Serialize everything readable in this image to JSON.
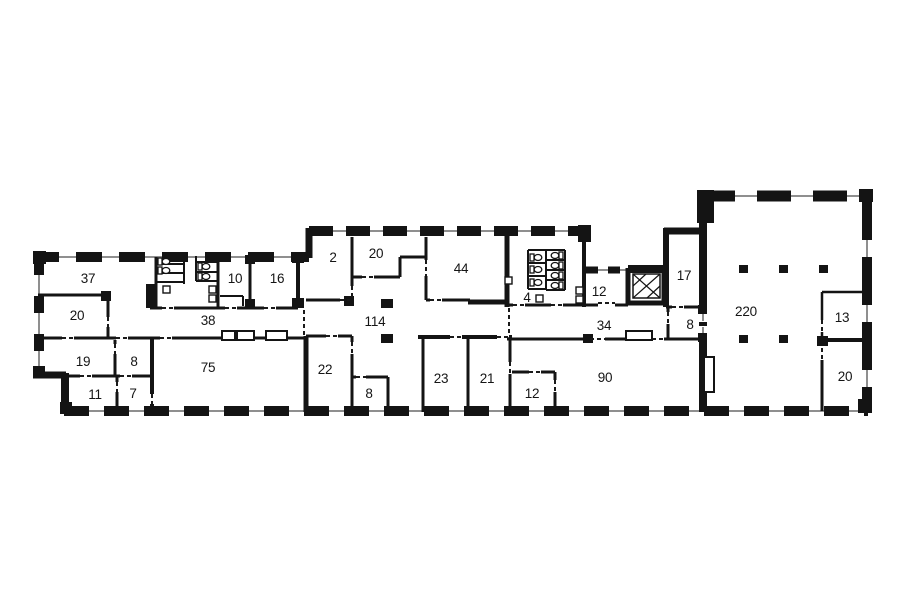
{
  "title": "office floor plan",
  "colors": {
    "background": "#ffffff",
    "wall": "#141414",
    "window_line": "#8f8f8f",
    "label": "#151515"
  },
  "rooms": [
    {
      "label": "37",
      "x": 88,
      "y": 278
    },
    {
      "label": "20",
      "x": 77,
      "y": 315
    },
    {
      "label": "19",
      "x": 83,
      "y": 361
    },
    {
      "label": "8",
      "x": 134,
      "y": 361
    },
    {
      "label": "11",
      "x": 95,
      "y": 394
    },
    {
      "label": "7",
      "x": 133,
      "y": 393
    },
    {
      "label": "38",
      "x": 208,
      "y": 320
    },
    {
      "label": "10",
      "x": 235,
      "y": 278
    },
    {
      "label": "16",
      "x": 277,
      "y": 278
    },
    {
      "label": "75",
      "x": 208,
      "y": 367
    },
    {
      "label": "2",
      "x": 333,
      "y": 257
    },
    {
      "label": "20",
      "x": 376,
      "y": 253
    },
    {
      "label": "44",
      "x": 461,
      "y": 268
    },
    {
      "label": "114",
      "x": 375,
      "y": 321
    },
    {
      "label": "22",
      "x": 325,
      "y": 369
    },
    {
      "label": "8",
      "x": 369,
      "y": 393
    },
    {
      "label": "23",
      "x": 441,
      "y": 378
    },
    {
      "label": "21",
      "x": 487,
      "y": 378
    },
    {
      "label": "12",
      "x": 532,
      "y": 393
    },
    {
      "label": "4",
      "x": 527,
      "y": 297
    },
    {
      "label": "12",
      "x": 599,
      "y": 291
    },
    {
      "label": "34",
      "x": 604,
      "y": 325
    },
    {
      "label": "17",
      "x": 684,
      "y": 275
    },
    {
      "label": "8",
      "x": 690,
      "y": 324
    },
    {
      "label": "90",
      "x": 605,
      "y": 377
    },
    {
      "label": "220",
      "x": 746,
      "y": 311
    },
    {
      "label": "13",
      "x": 842,
      "y": 317
    },
    {
      "label": "20",
      "x": 845,
      "y": 376
    }
  ],
  "fixtures": {
    "toilets": [
      {
        "x": 158,
        "y": 258,
        "dir": "e"
      },
      {
        "x": 158,
        "y": 267,
        "dir": "e"
      },
      {
        "x": 198,
        "y": 263,
        "dir": "e"
      },
      {
        "x": 198,
        "y": 273,
        "dir": "e"
      },
      {
        "x": 530,
        "y": 254,
        "dir": "e"
      },
      {
        "x": 530,
        "y": 266,
        "dir": "e"
      },
      {
        "x": 530,
        "y": 279,
        "dir": "e"
      },
      {
        "x": 563,
        "y": 252,
        "dir": "w"
      },
      {
        "x": 563,
        "y": 262,
        "dir": "w"
      },
      {
        "x": 563,
        "y": 272,
        "dir": "w"
      },
      {
        "x": 563,
        "y": 282,
        "dir": "w"
      }
    ],
    "sinks": [
      {
        "x": 163,
        "y": 286
      },
      {
        "x": 209,
        "y": 286
      },
      {
        "x": 209,
        "y": 295
      },
      {
        "x": 505,
        "y": 277
      },
      {
        "x": 536,
        "y": 295
      },
      {
        "x": 576,
        "y": 287
      },
      {
        "x": 576,
        "y": 296
      }
    ],
    "columns": [
      {
        "x": 381,
        "y": 299,
        "w": 12,
        "h": 9
      },
      {
        "x": 381,
        "y": 334,
        "w": 12,
        "h": 9
      },
      {
        "x": 739,
        "y": 265,
        "w": 9,
        "h": 8
      },
      {
        "x": 779,
        "y": 265,
        "w": 9,
        "h": 8
      },
      {
        "x": 819,
        "y": 265,
        "w": 9,
        "h": 8
      },
      {
        "x": 739,
        "y": 335,
        "w": 9,
        "h": 8
      },
      {
        "x": 779,
        "y": 335,
        "w": 9,
        "h": 8
      }
    ],
    "wall_niches": [
      {
        "x": 222,
        "y": 331,
        "w": 13,
        "h": 9
      },
      {
        "x": 237,
        "y": 331,
        "w": 17,
        "h": 9
      },
      {
        "x": 266,
        "y": 331,
        "w": 21,
        "h": 9
      },
      {
        "x": 626,
        "y": 331,
        "w": 26,
        "h": 9
      }
    ],
    "duct": {
      "x": 704,
      "y": 357,
      "w": 10,
      "h": 35
    },
    "elevator": {
      "x": 633,
      "y": 274,
      "w": 27,
      "h": 24
    }
  }
}
